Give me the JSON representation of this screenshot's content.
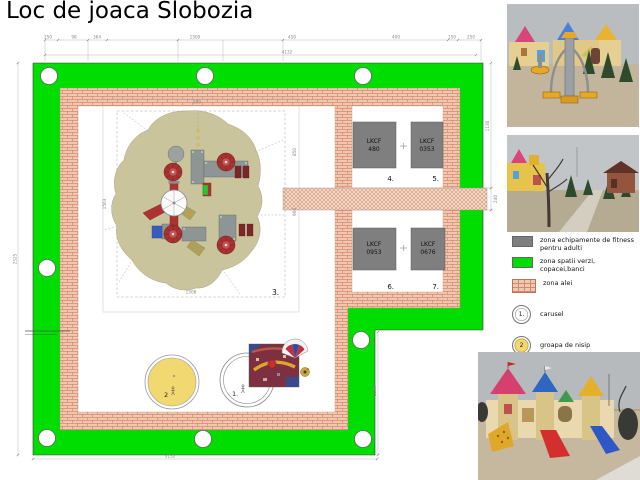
{
  "title": "Loc de joaca Slobozia",
  "plan": {
    "area_label": "3.",
    "fitness_units": [
      {
        "code": "LKCF",
        "model": "480",
        "num": "4."
      },
      {
        "code": "LKCF",
        "model": "0353",
        "num": "5."
      },
      {
        "code": "LKCF",
        "model": "0953",
        "num": "6."
      },
      {
        "code": "LKCF",
        "model": "0676",
        "num": "7."
      }
    ],
    "carousel_marker": "1.",
    "sandpit_marker": "2"
  },
  "dimensions": {
    "top_segments": [
      "250",
      "98",
      "364",
      "1500",
      "450",
      "400",
      "150",
      "250"
    ],
    "top_total": "4132",
    "left_total": "2525",
    "bottom_total": "3132",
    "right_upper": "1130",
    "right_path": "240",
    "notch_height": "1100",
    "inner_top": "500",
    "inner_left": "1503",
    "inner_right_a": "850",
    "inner_right_b": "900",
    "inner_bottom": "1508"
  },
  "legend": {
    "items": [
      {
        "swatch": "fitness-gray",
        "label": "zona echipamente de fitness pentru adulti"
      },
      {
        "swatch": "green-space",
        "label": "zona spatii verzi, copacei,banci"
      },
      {
        "swatch": "alei-brick",
        "label": "zona alei"
      }
    ],
    "markers": [
      {
        "symbol": "1.",
        "label": "carusel"
      },
      {
        "symbol": "2",
        "label": "groapa de nisip"
      }
    ]
  },
  "colors": {
    "green_zone": "#00dd00",
    "alei_base": "#f3c6ae",
    "alei_line": "#cf8b72",
    "fitness_gray": "#7f7f7f",
    "sand_blob": "#c9c49c",
    "sand_pit": "#f2d870"
  },
  "photos": [
    {
      "name": "fitness equipment in playground"
    },
    {
      "name": "park alley with trees"
    },
    {
      "name": "castle playground with slides"
    }
  ]
}
